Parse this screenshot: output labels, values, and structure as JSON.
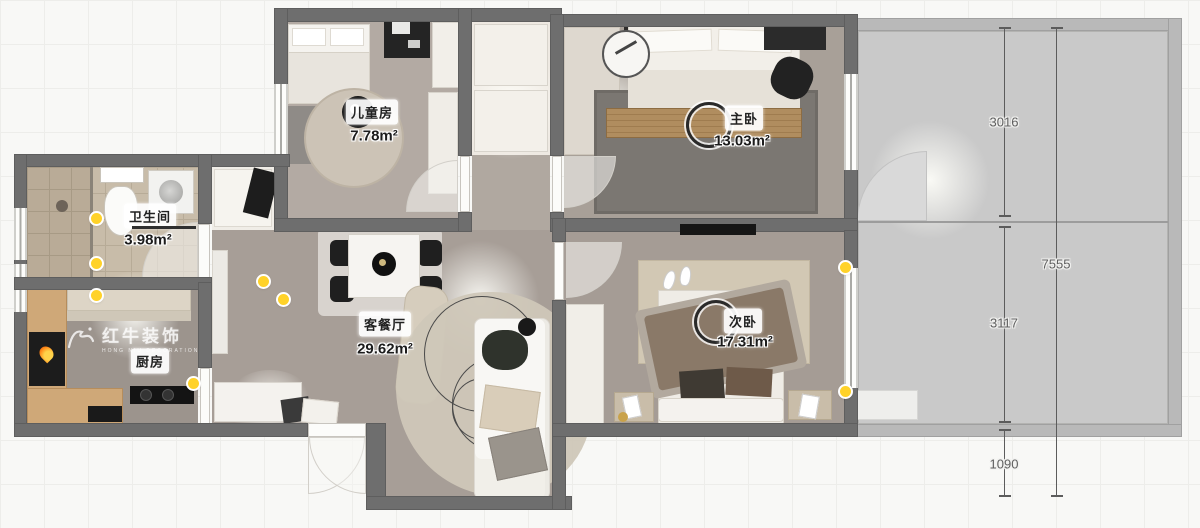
{
  "title": "apartment-floor-plan",
  "watermark": {
    "brand": "红牛装饰",
    "brand_en": "HONG NIU DECORATION",
    "registered": "®"
  },
  "rooms": {
    "kids": {
      "name": "儿童房",
      "area": "7.78m²"
    },
    "master": {
      "name": "主卧",
      "area": "13.03m²"
    },
    "bath": {
      "name": "卫生间",
      "area": "3.98m²"
    },
    "living": {
      "name": "客餐厅",
      "area": "29.62m²"
    },
    "kitchen": {
      "name": "厨房"
    },
    "second": {
      "name": "次卧",
      "area": "17.31m²"
    }
  },
  "dimensions": {
    "right_col_top": "3016",
    "right_col_mid": "3117",
    "right_col_bottom": "1090",
    "right_overall": "7555"
  },
  "colors": {
    "wall": "#6e6e6e",
    "annex_wall": "#b9b9b9",
    "annex_floor": "#c9c9c9",
    "light_dot": "#ffd229",
    "floor_taupe": "#aca39b"
  }
}
